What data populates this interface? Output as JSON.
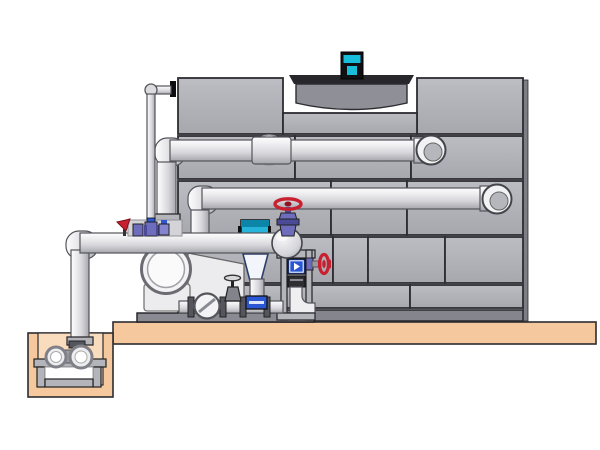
{
  "colors": {
    "bg": "#ffffff",
    "outline": "#2c2c31",
    "panel": "#a7a7ae",
    "panel_light": "#bcbcc3",
    "panel_side": "#7d7d85",
    "tower_base": "#85858d",
    "fan_body": "#8f8f97",
    "fan_rim": "#27272c",
    "motor_teal": "#17bdd9",
    "motor_dark": "#101014",
    "pipe_hi": "#fdfdfe",
    "pipe_light": "#efeff2",
    "pipe_mid": "#d7d7db",
    "pipe_shadow": "#a6a6ad",
    "pipe_edge": "#54545b",
    "platform": "#f5c89e",
    "platform_light": "#f9dcbd",
    "metal": "#b4b4bb",
    "metal_mid": "#8a8a92",
    "metal_dark": "#55555d",
    "valve_red": "#c92030",
    "valve_red_dark": "#8e1220",
    "valve_purple": "#6d6cbd",
    "valve_purple_dark": "#4b4a96",
    "accent_blue": "#2b57d4",
    "teal_valve": "#27b4da",
    "teal_valve_dark": "#0d85a8",
    "light": "#ececef",
    "cone_edge": "#2c3e66"
  },
  "components": {
    "scene": "cooling tower installation diagram",
    "cooling_tower": "cooling tower casing",
    "fan_cowl": "fan cowl",
    "fan_motor": "fan motor",
    "supply_pipe": "upper supply pipe",
    "return_pipe": "lower supply pipe",
    "makeup_pipe": "make-up water pipe",
    "main_pipe": "pump suction header",
    "pump": "centrifugal pump",
    "sump_pit": "sump pit",
    "sump_pump": "sump pump",
    "platform": "concrete platform",
    "globe_valve": "red handwheel globe valve",
    "control_valve": "level control valve",
    "strainer": "strainer check valve",
    "gate_valve": "gate valve",
    "side_handwheel": "side handwheel valve",
    "meter": "flow meter",
    "frame": "support frame",
    "skid": "pump skid base"
  }
}
